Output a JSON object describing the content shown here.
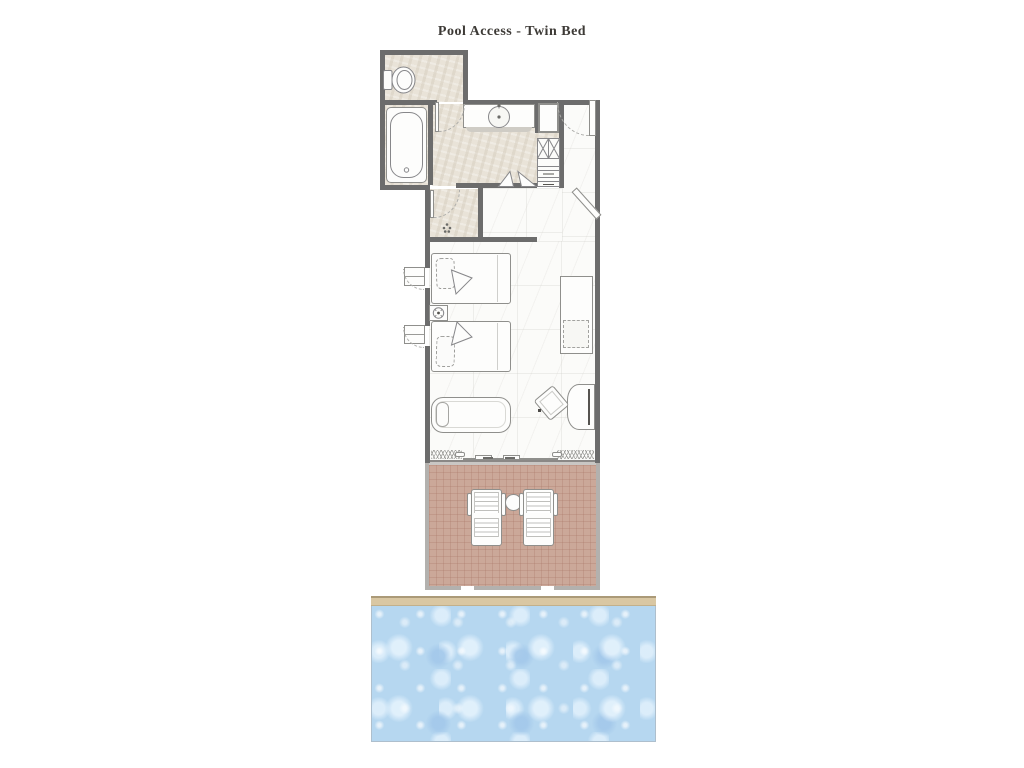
{
  "title": "Pool Access - Twin Bed",
  "plan": {
    "rooms": [
      {
        "name": "toilet-room",
        "fixtures": [
          "toilet"
        ]
      },
      {
        "name": "bathroom",
        "fixtures": [
          "bathtub",
          "vanity-counter",
          "sink-basin",
          "faucet"
        ]
      },
      {
        "name": "dressing-area",
        "fixtures": [
          "tall-cabinet",
          "wardrobe-shelves",
          "luggage-rack"
        ]
      },
      {
        "name": "shower-room",
        "fixtures": [
          "shower-head",
          "shower-door"
        ]
      },
      {
        "name": "entry",
        "fixtures": [
          "entry-door",
          "full-length-mirror"
        ]
      },
      {
        "name": "bedroom",
        "fixtures": [
          "twin-bed-1",
          "twin-bed-2",
          "nightstand-with-lamp",
          "casement-window-1",
          "casement-window-2",
          "console-table",
          "stool",
          "desk",
          "chair",
          "daybed-bench",
          "sliding-glass-door",
          "curtain-left",
          "curtain-right"
        ]
      },
      {
        "name": "terrace",
        "fixtures": [
          "sun-lounger-1",
          "sun-lounger-2",
          "side-table"
        ]
      },
      {
        "name": "pool",
        "fixtures": [
          "pool-coping",
          "pool-water"
        ]
      }
    ],
    "colors": {
      "wall": "#6c6c6c",
      "terrace_wall": "#b3b1ae",
      "bath_floor": "#e9e3d8",
      "bedroom_floor": "#fbfbf9",
      "terrace_tile": "#cba899",
      "pool_water": "#b6d7f0",
      "pool_coping": "#d9c7a3",
      "furniture_outline": "#8f8f8c"
    }
  }
}
